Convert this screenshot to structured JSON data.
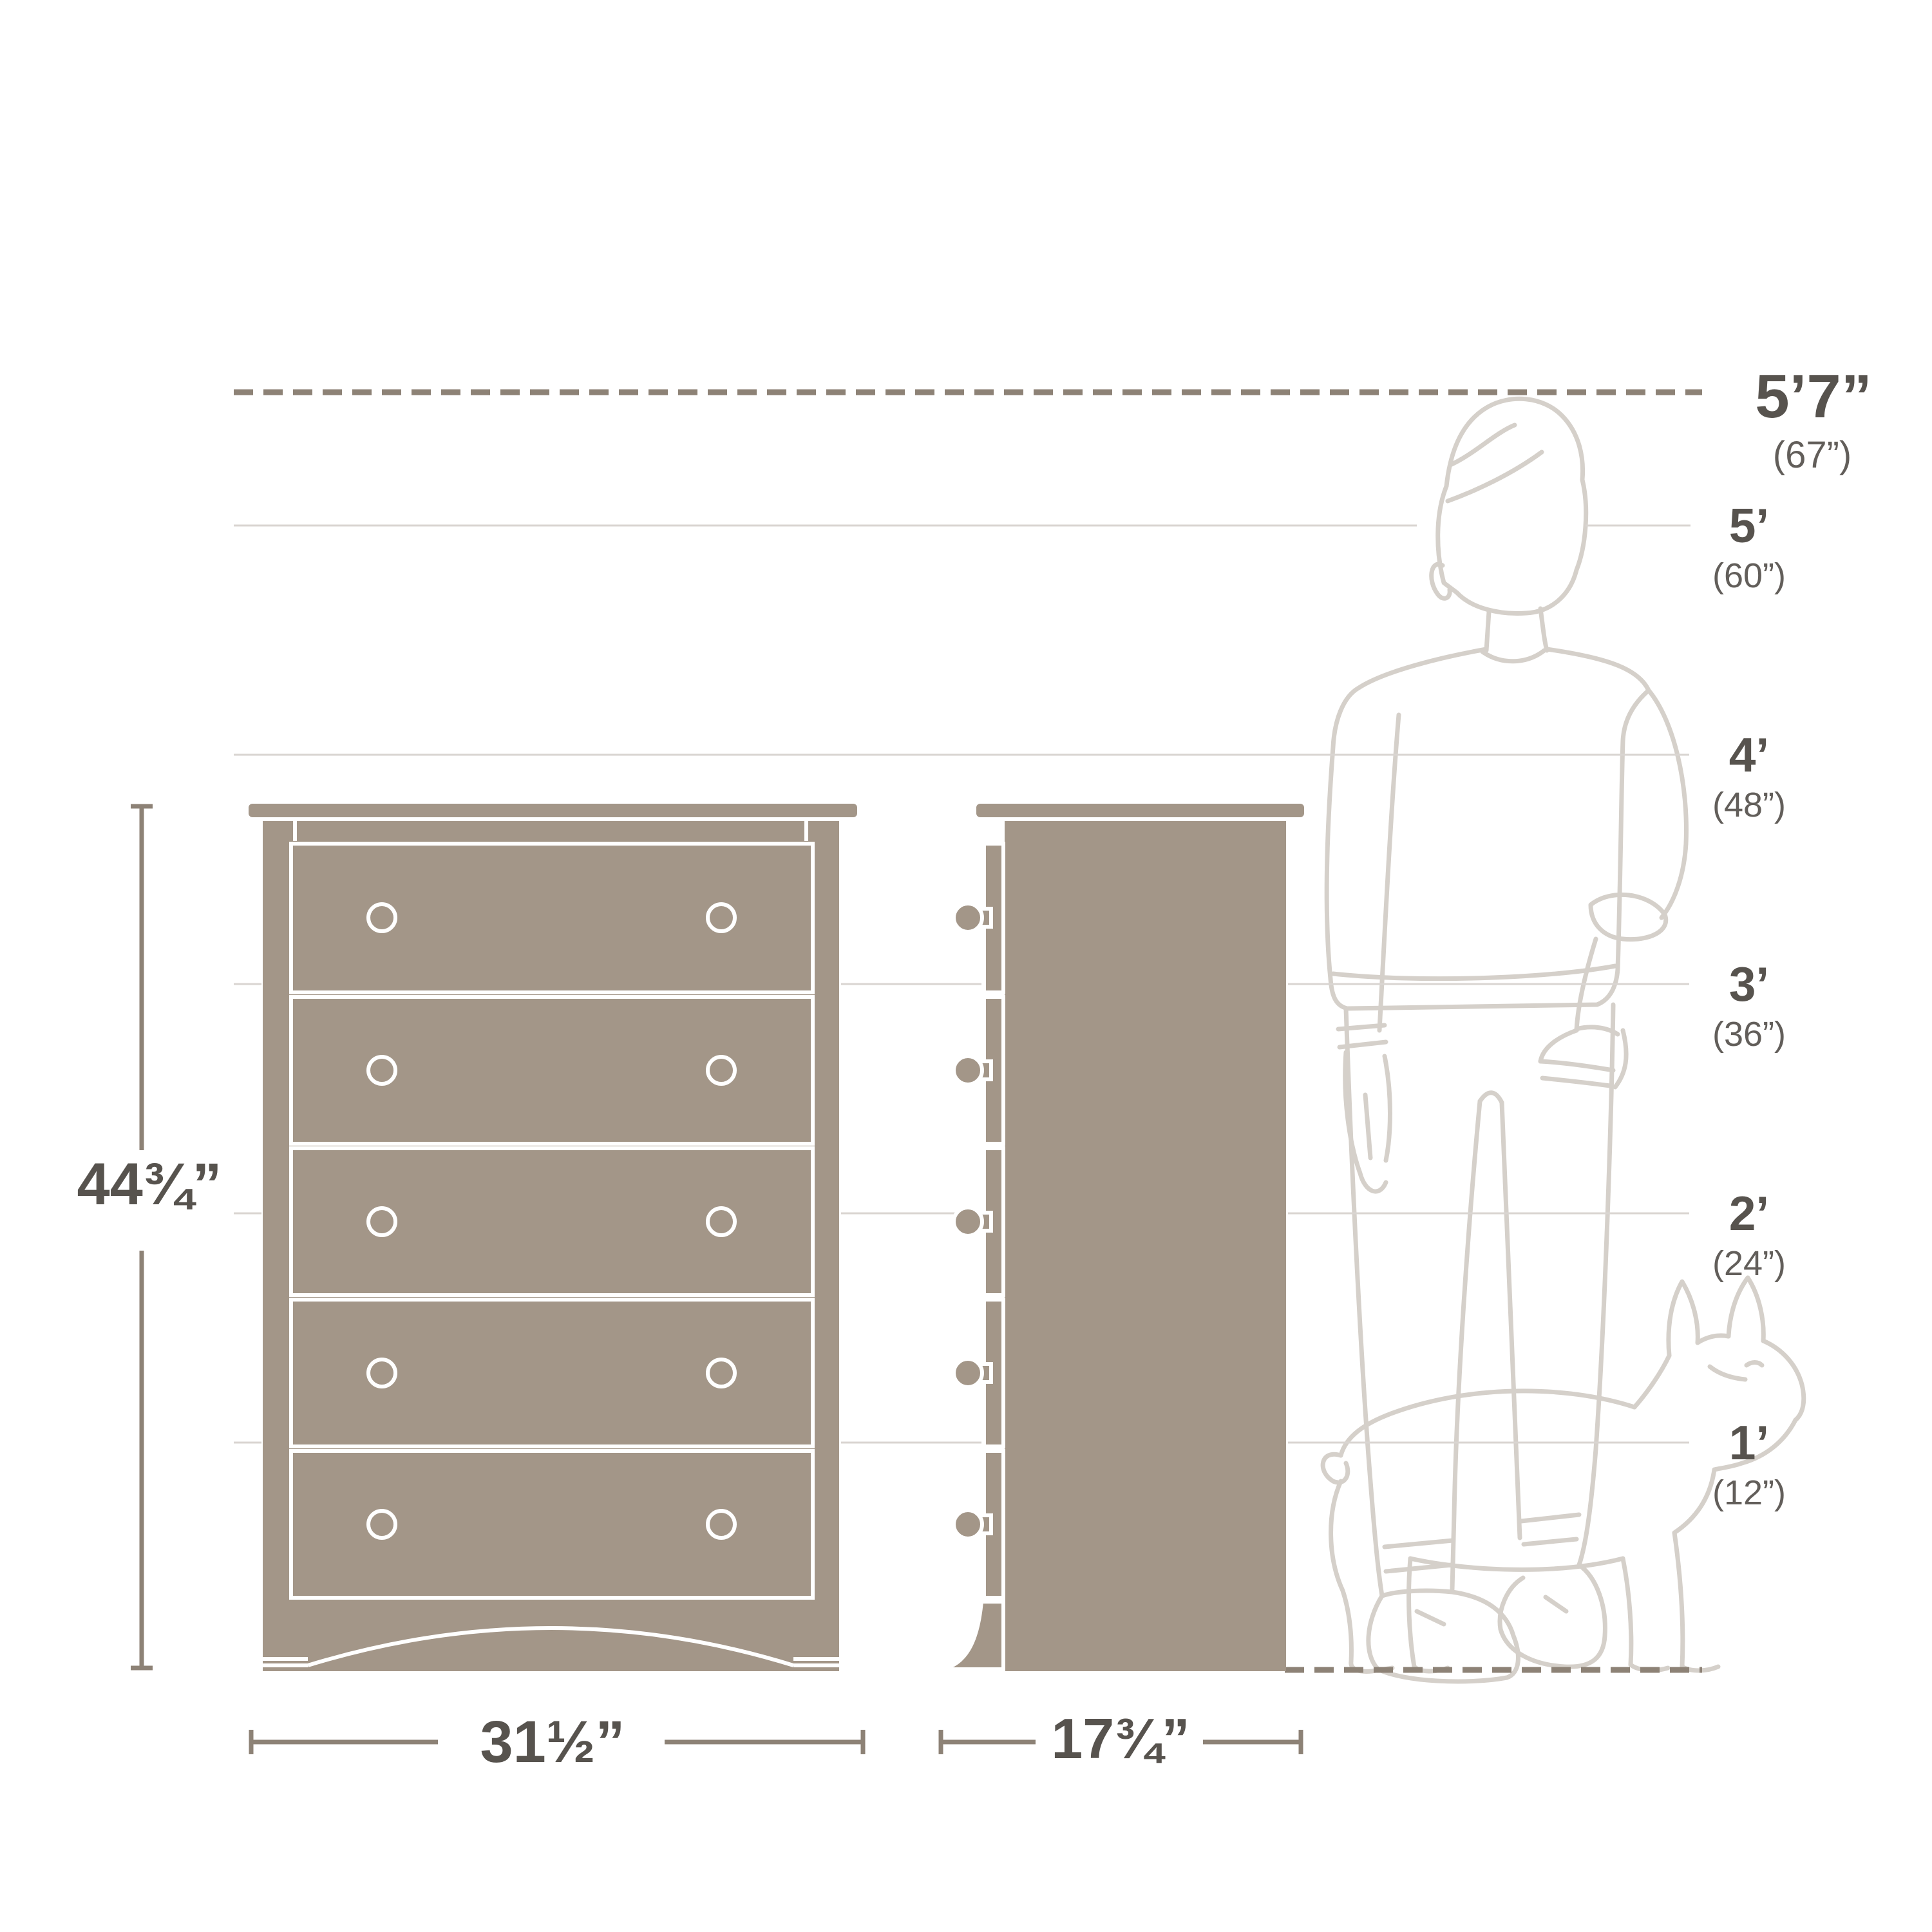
{
  "diagram": {
    "height_markers": [
      {
        "feet": "5’7”",
        "inches": "(67”)"
      },
      {
        "feet": "5’",
        "inches": "(60”)"
      },
      {
        "feet": "4’",
        "inches": "(48”)"
      },
      {
        "feet": "3’",
        "inches": "(36”)"
      },
      {
        "feet": "2’",
        "inches": "(24”)"
      },
      {
        "feet": "1’",
        "inches": "(12”)"
      }
    ],
    "dimensions": {
      "height": "44¾”",
      "width": "31½”",
      "depth": "17¾”"
    },
    "colors": {
      "background": "#ffffff",
      "furniture_fill": "#a39688",
      "furniture_outline": "#ffffff",
      "dimension_line": "#8d8276",
      "grid_line": "#d9d5d1",
      "silhouette_line": "#d5d0ca",
      "label_primary": "#57534e",
      "label_secondary": "#625e5a"
    }
  }
}
